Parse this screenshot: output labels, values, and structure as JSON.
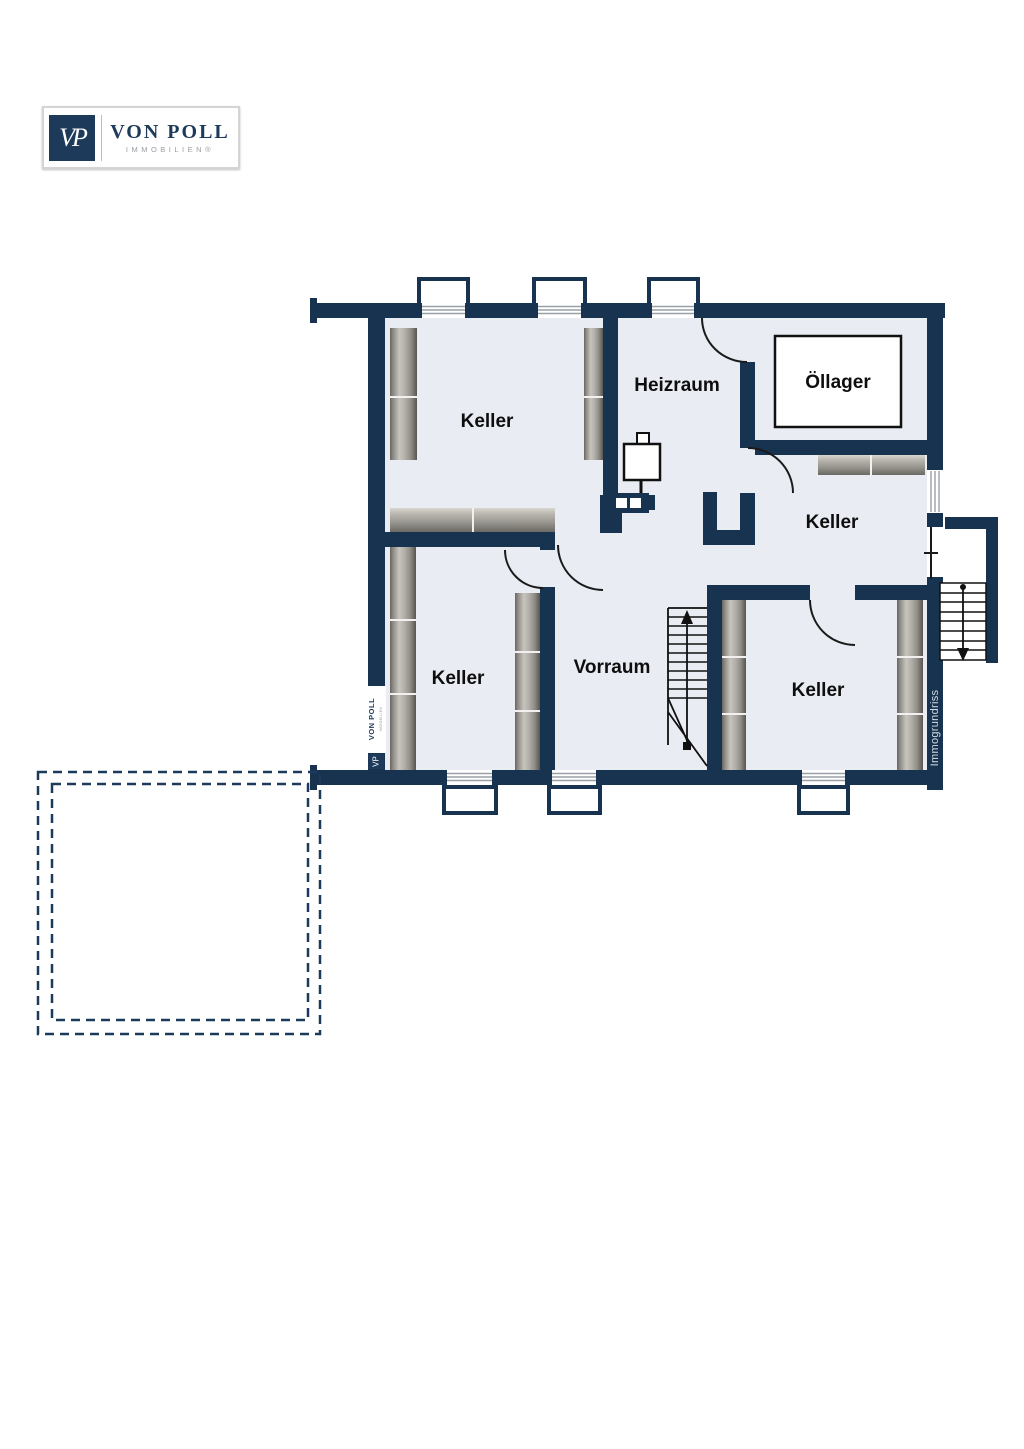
{
  "logo": {
    "monogram": "VP",
    "name": "VON POLL",
    "subtitle": "IMMOBILIEN®"
  },
  "rooms": {
    "keller_nw": "Keller",
    "heizraum": "Heizraum",
    "oellager": "Öllager",
    "keller_e": "Keller",
    "keller_sw": "Keller",
    "vorraum": "Vorraum",
    "keller_se": "Keller"
  },
  "watermarks": {
    "wall_logo_monogram": "VP",
    "wall_logo_name": "VON POLL",
    "wall_logo_sub": "IMMOBILIEN",
    "brand": "Immogrundriss"
  },
  "colors": {
    "wall": "#17334f",
    "room_fill": "#e9ecf2",
    "logo_navy": "#1d3a5a",
    "line_black": "#1a1a1a",
    "window_hatch": "#98a0a8",
    "dashed_outline": "#1c3a5c"
  }
}
